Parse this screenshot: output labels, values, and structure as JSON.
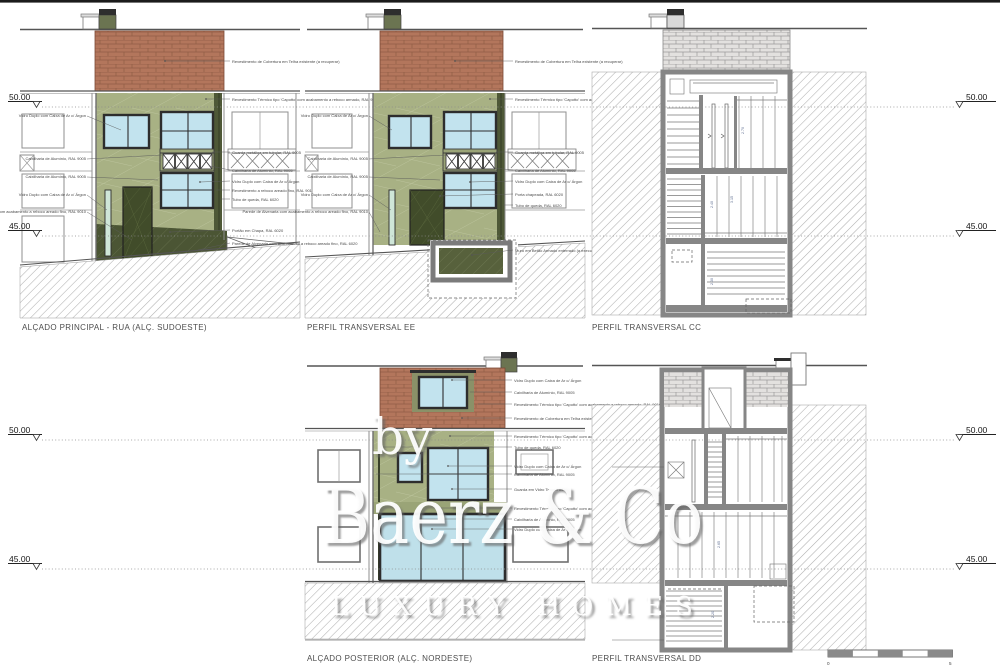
{
  "page": {
    "background": "#ffffff",
    "top_border": "#1b1b1b"
  },
  "palette": {
    "facade_green": "#a8b184",
    "facade_green_line": "#bcc49c",
    "dark_olive": "#4b5534",
    "door_olive": "#414c2a",
    "glass_blue": "#c2e3ee",
    "brick_red": "#b3765c",
    "brick_red_line": "#905d45",
    "brick_grey": "#e3e1df",
    "section_wall": "#868686",
    "hatch_line": "#b0b0b0",
    "label_grey": "#4a4a4a",
    "title_grey": "#4d4d4d",
    "dim_blue": "#5f6f92"
  },
  "titles": [
    "ALÇADO PRINCIPAL - RUA (ALÇ. SUDOESTE)",
    "PERFIL TRANSVERSAL EE",
    "PERFIL TRANSVERSAL CC",
    "ALÇADO POSTERIOR (ALÇ. NORDESTE)",
    "PERFIL TRANSVERSAL DD"
  ],
  "levels": {
    "l50": "50.00",
    "l45": "45.00"
  },
  "watermark": {
    "by": "by",
    "name": "Baerz & Co",
    "tagline": "LUXURY HOMES"
  },
  "scalebar": {
    "zero": "0",
    "five": "5"
  },
  "dims": {
    "d3": [
      "2.70",
      "2.40",
      "3.15",
      "2.30"
    ],
    "d5": [
      "2.65",
      "2.20"
    ]
  },
  "annotations": {
    "d1_left": [
      "Vidro Duplo com Caixa de Ar c/ Árgon",
      "Caixilharia de Alumínio, RAL 9005",
      "Caixilharia de Alumínio, RAL 9005",
      "Vidro Duplo com Caixa de Ar c/ Árgon",
      "Parede de Alvenaria com acabamento a reboco areado fino, RAL 9010"
    ],
    "d1_right": [
      "Revestimento de Cobertura em Telha existente (a recuperar)",
      "Revestimento Térmico tipo 'Capotto' com acabamento a reboco armado, RAL 9010",
      "Guarda metálica em tubular, RAL 9005",
      "Caixilharia de Alumínio, RAL 9005",
      "Vidro Duplo com Caixa de Ar c/ Árgon",
      "Revestimento a reboco areado fino, RAL 9010",
      "Tubo de queda, RAL 6020",
      "Portão em Chapa, RAL 6020",
      "Parede de Alvenaria com acabamento a reboco areado fino, RAL 6020"
    ],
    "d2_left": [
      "Vidro Duplo com Caixa de Ar c/ Árgon",
      "Caixilharia de Alumínio, RAL 9005",
      "Caixilharia de Alumínio, RAL 9005",
      "Vidro Duplo com Caixa de Ar c/ Árgon",
      "Parede de Alvenaria com acabamento a reboco areado fino, RAL 9010"
    ],
    "d2_right": [
      "Revestimento de Cobertura em Telha existente (a recuperar)",
      "Revestimento Térmico tipo 'Capotto' com acabamento a reboco armado, RAL 9010",
      "Guarda metálica em tubular, RAL 9005",
      "Caixilharia de Alumínio, RAL 9005",
      "Vidro Duplo com Caixa de Ar c/ Árgon",
      "Porta chapeada, RAL 6020",
      "Tubo de queda, RAL 6020",
      "Muro em Betão Armado enterrado (a executar)"
    ],
    "d4_top": [
      "Vidro Duplo com Caixa de Ar c/ Árgon",
      "Caixilharia de Alumínio, RAL 9005",
      "Revestimento Térmico tipo 'Capotto' com acabamento a reboco armado, RAL 9010",
      "Revestimento de Cobertura em Telha existente (a recuperar)"
    ],
    "d4_right": [
      "Revestimento Térmico tipo 'Capotto' com acabamento a reboco armado, RAL 9010",
      "Tubo de queda, RAL 6020",
      "Vidro Duplo com Caixa de Ar c/ Árgon",
      "Caixilharia de Alumínio, RAL 9005",
      "Guarda em Vidro Temperado",
      "Revestimento Térmico tipo 'Capotto' com acabamento armado",
      "Caixilharia de Alumínio, RAL 9005",
      "Vidro Duplo com Caixa de Ar c/ Árgon"
    ]
  }
}
